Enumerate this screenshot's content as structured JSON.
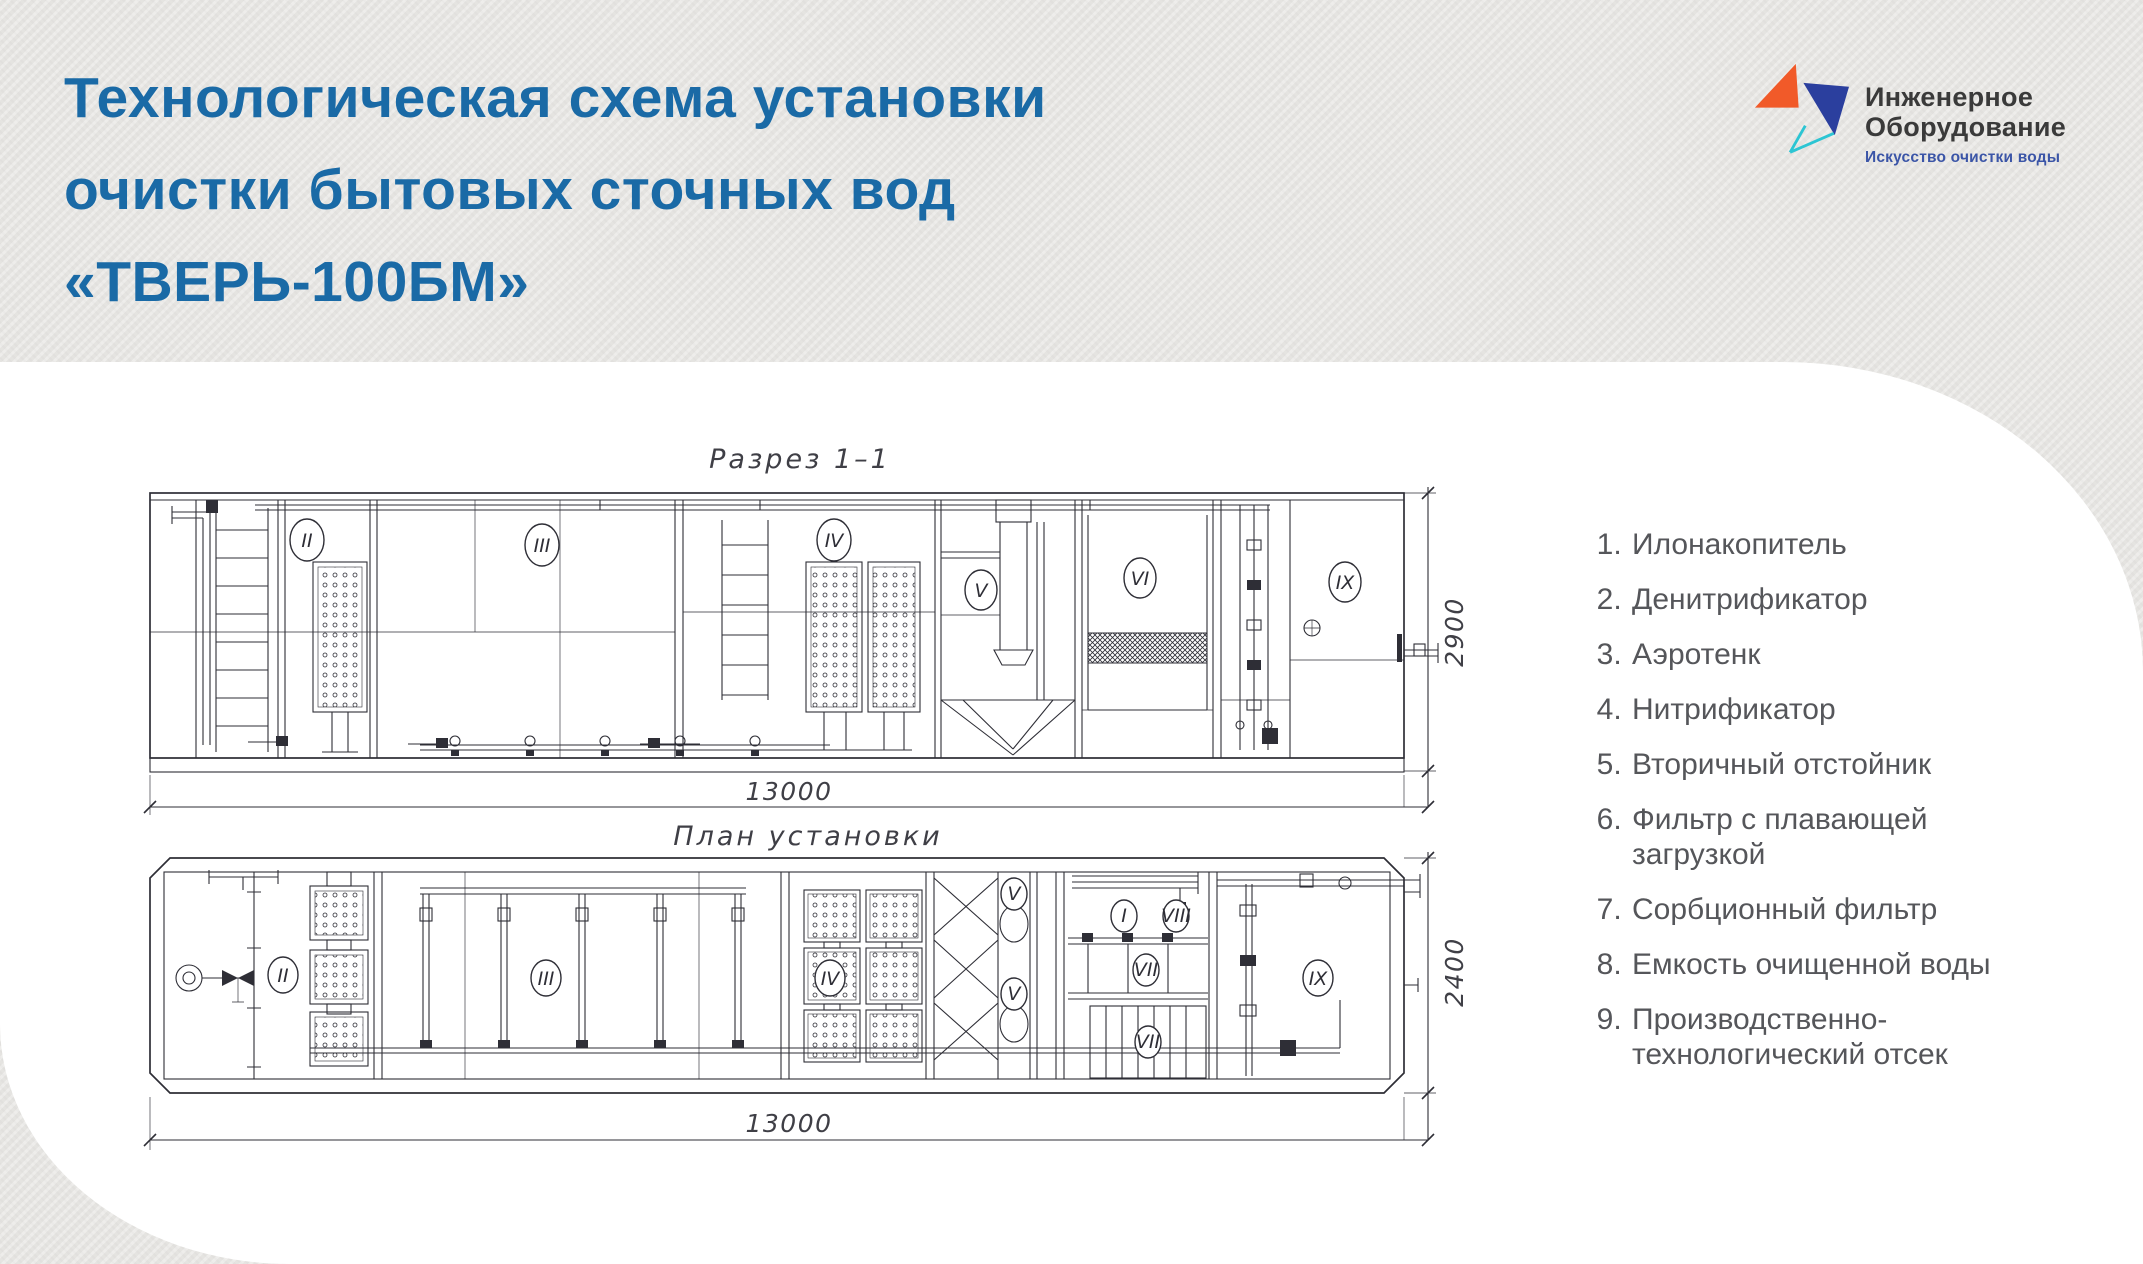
{
  "header": {
    "title_lines": [
      "Технологическая схема установки",
      "очистки бытовых сточных вод",
      "«ТВЕРЬ-100БМ»"
    ]
  },
  "logo": {
    "name_line1": "Инженерное",
    "name_line2": "Оборудование",
    "tagline": "Искусство очистки воды"
  },
  "section_view": {
    "title": "Разрез 1–1",
    "length_dim": "13000",
    "height_dim": "2900",
    "labels": [
      "II",
      "III",
      "IV",
      "V",
      "VI",
      "IX"
    ]
  },
  "plan_view": {
    "title": "План установки",
    "length_dim": "13000",
    "width_dim": "2400",
    "labels": [
      "II",
      "III",
      "IV",
      "V",
      "V",
      "I",
      "VIII",
      "VII",
      "VII",
      "IX"
    ]
  },
  "legend": {
    "items": [
      "Илонакопитель",
      "Денитрификатор",
      "Аэротенк",
      "Нитрификатор",
      "Вторичный отстойник",
      "Фильтр с плавающей загрузкой",
      "Сорбционный фильтр",
      "Емкость очищенной воды",
      "Производственно-технологический отсек"
    ]
  },
  "colors": {
    "accent_blue": "#1a6aa6",
    "logo_orange": "#f15a29",
    "logo_blue": "#2b3f9e",
    "logo_teal": "#2cc5d3",
    "tagline_blue": "#3b55a7",
    "legend_text_gray": "#55565a",
    "drawing_line": "#2e2e36",
    "panel_white": "#ffffff",
    "background_gray": "#e5e4e1"
  }
}
